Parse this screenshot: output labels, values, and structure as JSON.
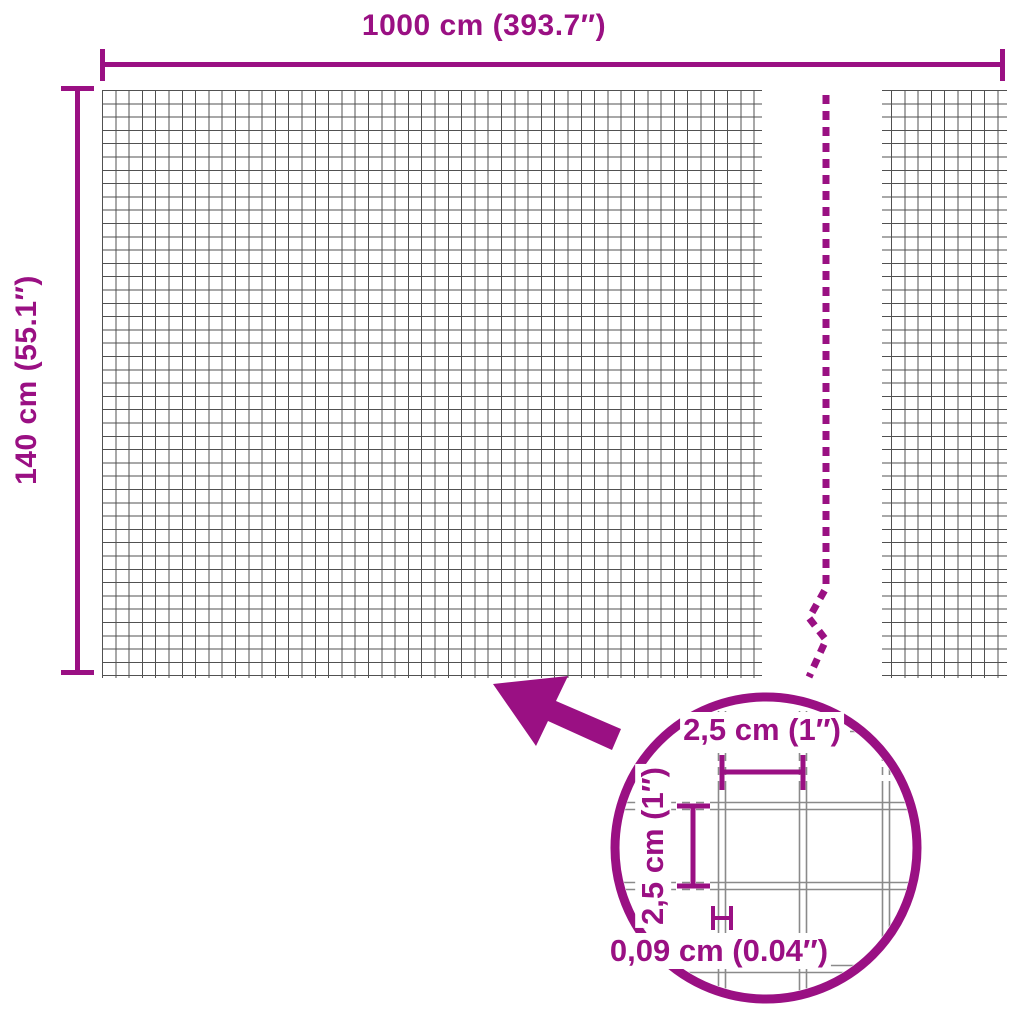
{
  "diagram": {
    "product": "wire mesh fence dimension diagram",
    "width_label": "1000 cm (393.7″)",
    "height_label": "140 cm (55.1″)",
    "detail": {
      "mesh_width_label": "2,5 cm (1″)",
      "mesh_height_label": "2,5 cm (1″)",
      "wire_thickness_label": "0,09 cm (0.04″)"
    },
    "colors": {
      "accent": "#9A1083",
      "grid_line": "#515151",
      "wire_line": "#8A8A8A",
      "background": "#FFFFFF"
    }
  }
}
